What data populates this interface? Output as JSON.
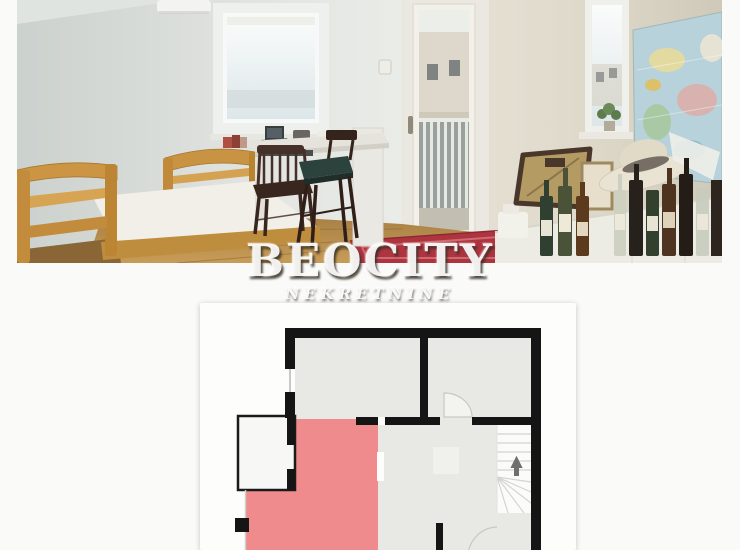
{
  "watermark": {
    "brand": "BEOCITY",
    "tagline": "NEKRETNINE"
  },
  "floor_plan": {
    "wall_color": "#151515",
    "room_fill": "#e8e8e5",
    "highlight_color": "#ef8a8d",
    "balcony_fill": "#f7f7f5",
    "stairs_up_arrow": "▲"
  }
}
